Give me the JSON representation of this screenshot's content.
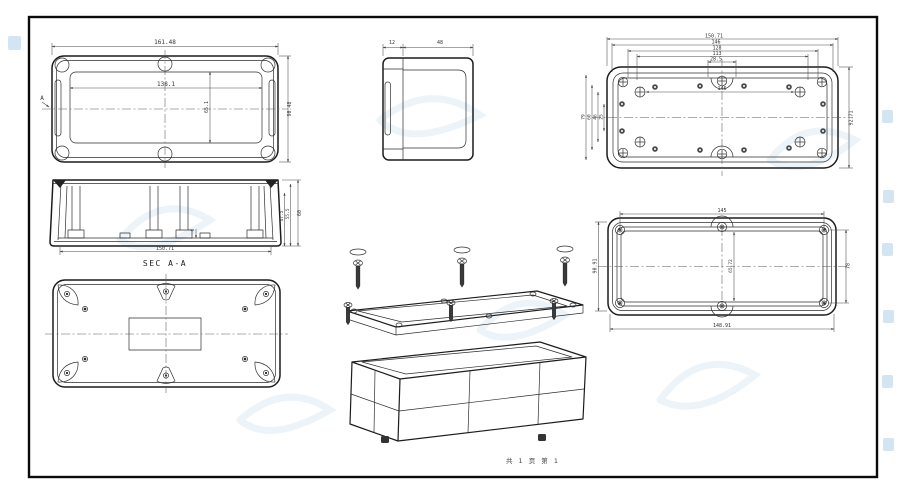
{
  "sheet": {
    "page_note": "共 1 页  第 1"
  },
  "lid_top": {
    "section_marker": "A",
    "overall_width": "161.48",
    "inner_width": "138.1",
    "inner_height": "65.1",
    "overall_height": "90.48"
  },
  "side": {
    "lid_width": "12",
    "base_width": "48"
  },
  "base_inside": {
    "chain": [
      "150.71",
      "146",
      "128",
      "113",
      "28.5"
    ],
    "inner_width": "146",
    "height": "92.71",
    "left_chain": [
      "79",
      "60",
      "46",
      "25"
    ]
  },
  "section": {
    "label": "SEC A-A",
    "width": "150.71",
    "h1": "47.5",
    "h2": "55.5",
    "h3": "60",
    "recess": "6"
  },
  "lid_inside": {
    "top": "145",
    "bottom": "148.91",
    "left": "90.91",
    "right": "78",
    "center": "65.72"
  }
}
